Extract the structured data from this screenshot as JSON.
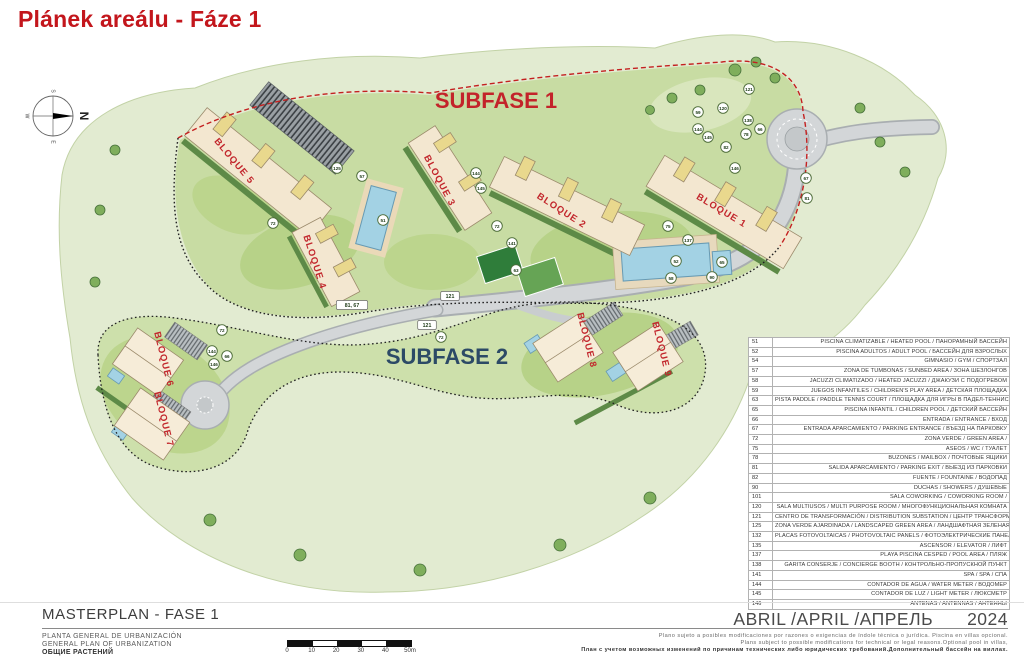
{
  "header": {
    "title": "Plánek areálu - Fáze 1"
  },
  "plan": {
    "subfase1_label": "SUBFASE 1",
    "subfase2_label": "SUBFASE 2",
    "compass": {
      "top": "S",
      "right": "N",
      "bottom": "E",
      "left": "W"
    },
    "bloques": [
      {
        "label": "BLOQUE 5",
        "x": 232,
        "y": 163,
        "rot": 50
      },
      {
        "label": "BLOQUE 3",
        "x": 437,
        "y": 182,
        "rot": 62
      },
      {
        "label": "BLOQUE 2",
        "x": 560,
        "y": 213,
        "rot": 33
      },
      {
        "label": "BLOQUE 1",
        "x": 720,
        "y": 213,
        "rot": 31
      },
      {
        "label": "BLOQUE 4",
        "x": 312,
        "y": 263,
        "rot": 72
      },
      {
        "label": "BLOQUE 6",
        "x": 161,
        "y": 360,
        "rot": 76
      },
      {
        "label": "BLOQUE 7",
        "x": 161,
        "y": 420,
        "rot": 76
      },
      {
        "label": "BLOQUE 8",
        "x": 584,
        "y": 341,
        "rot": 76
      },
      {
        "label": "BLOQUE 9",
        "x": 659,
        "y": 350,
        "rot": 76
      }
    ],
    "markers": [
      {
        "n": "125",
        "x": 337,
        "y": 168
      },
      {
        "n": "57",
        "x": 362,
        "y": 176
      },
      {
        "n": "51",
        "x": 383,
        "y": 220
      },
      {
        "n": "72",
        "x": 273,
        "y": 223
      },
      {
        "n": "72",
        "x": 497,
        "y": 226
      },
      {
        "n": "144",
        "x": 476,
        "y": 173
      },
      {
        "n": "145",
        "x": 481,
        "y": 188
      },
      {
        "n": "141",
        "x": 512,
        "y": 243
      },
      {
        "n": "63",
        "x": 516,
        "y": 270
      },
      {
        "n": "59",
        "x": 698,
        "y": 112
      },
      {
        "n": "120",
        "x": 723,
        "y": 108
      },
      {
        "n": "121",
        "x": 749,
        "y": 89
      },
      {
        "n": "138",
        "x": 748,
        "y": 120
      },
      {
        "n": "66",
        "x": 760,
        "y": 129
      },
      {
        "n": "144",
        "x": 698,
        "y": 129
      },
      {
        "n": "145",
        "x": 708,
        "y": 137
      },
      {
        "n": "78",
        "x": 746,
        "y": 134
      },
      {
        "n": "82",
        "x": 726,
        "y": 147
      },
      {
        "n": "146",
        "x": 735,
        "y": 168
      },
      {
        "n": "67",
        "x": 806,
        "y": 178
      },
      {
        "n": "81",
        "x": 807,
        "y": 198
      },
      {
        "n": "75",
        "x": 668,
        "y": 226
      },
      {
        "n": "137",
        "x": 688,
        "y": 240
      },
      {
        "n": "52",
        "x": 676,
        "y": 261
      },
      {
        "n": "65",
        "x": 722,
        "y": 262
      },
      {
        "n": "58",
        "x": 671,
        "y": 278
      },
      {
        "n": "90",
        "x": 712,
        "y": 277
      },
      {
        "n": "121",
        "x": 450,
        "y": 296,
        "box": true
      },
      {
        "n": "81, 67",
        "x": 352,
        "y": 305,
        "box": true
      },
      {
        "n": "121",
        "x": 427,
        "y": 325,
        "box": true
      },
      {
        "n": "66",
        "x": 227,
        "y": 356
      },
      {
        "n": "144",
        "x": 212,
        "y": 351
      },
      {
        "n": "146",
        "x": 214,
        "y": 364
      },
      {
        "n": "72",
        "x": 441,
        "y": 337
      },
      {
        "n": "72",
        "x": 222,
        "y": 330
      }
    ]
  },
  "legend": {
    "rows": [
      {
        "num": "51",
        "desc": "PISCINA CLIMATIZABLE / HEATED POOL / ПАНОРАМНЫЙ БАССЕЙН"
      },
      {
        "num": "52",
        "desc": "PISCINA ADULTOS / ADULT POOL / БАССЕЙН ДЛЯ ВЗРОСЛЫХ"
      },
      {
        "num": "54",
        "desc": "GIMNASIO / GYM / СПОРТЗАЛ"
      },
      {
        "num": "57",
        "desc": "ZONA DE TUMBONAS / SUNBED AREA / ЗОНА ШЕЗЛОНГОВ"
      },
      {
        "num": "58",
        "desc": "JACUZZI CLIMATIZADO / HEATED JACUZZI / ДЖАКУЗИ С ПОДОГРЕВОМ"
      },
      {
        "num": "59",
        "desc": "JUEGOS INFANTILES / CHILDREN'S PLAY AREA / ДЕТСКАЯ ПЛОЩАДКА"
      },
      {
        "num": "63",
        "desc": "PISTA PADDLE / PADDLE TENNIS COURT / ПЛОЩАДКА ДЛЯ ИГРЫ В ПАДЕЛ-ТЕННИС"
      },
      {
        "num": "65",
        "desc": "PISCINA INFANTIL / CHILDREN POOL / ДЕТСКИЙ БАССЕЙН"
      },
      {
        "num": "66",
        "desc": "ENTRADA / ENTRANCE / ВХОД"
      },
      {
        "num": "67",
        "desc": "ENTRADA APARCAMIENTO / PARKING ENTRANCE / ВЪЕЗД НА ПАРКОВКУ"
      },
      {
        "num": "72",
        "desc": "ZONA VERDE / GREEN AREA /"
      },
      {
        "num": "75",
        "desc": "ASEOS / WC / ТУАЛЕТ"
      },
      {
        "num": "78",
        "desc": "BUZONES / MAILBOX / ПОЧТОВЫЕ ЯЩИКИ"
      },
      {
        "num": "81",
        "desc": "SALIDA APARCAMIENTO / PARKING EXIT / ВЫЕЗД ИЗ ПАРКОВКИ"
      },
      {
        "num": "82",
        "desc": "FUENTE / FOUNTAINE / ВОДОПАД"
      },
      {
        "num": "90",
        "desc": "DUCHAS / SHOWERS / ДУШЕВЫЕ"
      },
      {
        "num": "101",
        "desc": "SALA COWORKING / COWORKING ROOM /"
      },
      {
        "num": "120",
        "desc": "SALA MULTIUSOS / MULTI PURPOSE ROOM / МНОГОФУНКЦИОНАЛЬНАЯ КОМНАТА"
      },
      {
        "num": "121",
        "desc": "CENTRO DE TRANSFORMACIÓN / DISTRIBUTION SUBSTATION / ЦЕНТР ТРАНСФОРМАЦИИ"
      },
      {
        "num": "125",
        "desc": "ZONA VERDE AJARDINADA / LANDSCAPED GREEN AREA / ЛАНДШАФТНАЯ ЗЕЛЕНАЯ ЗОНА"
      },
      {
        "num": "132",
        "desc": "PLACAS FOTOVOLTAICAS / PHOTOVOLTAIC PANELS / ФОТОЭЛЕКТРИЧЕСКИЕ ПАНЕЛИ"
      },
      {
        "num": "135",
        "desc": "ASCENSOR / ELEVATOR / ЛИФТ"
      },
      {
        "num": "137",
        "desc": "PLAYA PISCINA CESPED / POOL AREA / ПЛЯЖ"
      },
      {
        "num": "138",
        "desc": "GARITA CONSERJE / CONCIERGE BOOTH / КОНТРОЛЬНО-ПРОПУСКНОЙ ПУНКТ"
      },
      {
        "num": "141",
        "desc": "SPA / SPA / СПА"
      },
      {
        "num": "144",
        "desc": "CONTADOR DE AGUA / WATER METER / ВОДОМЕР"
      },
      {
        "num": "145",
        "desc": "CONTADOR DE LUZ / LIGHT METER / ЛЮКСМЕТР"
      },
      {
        "num": "146",
        "desc": "ANTENAS / ANTENNAS / АНТЕННЫ"
      }
    ]
  },
  "footer": {
    "project_title": "MASTERPLAN - FASE 1",
    "subtitle_es": "PLANTA GENERAL DE URBANIZACIÓN",
    "subtitle_en": "GENERAL PLAN OF URBANIZATION",
    "subtitle_ru": "ОБЩИЕ РАСТЕНИЙ",
    "date_label": "ABRIL /APRIL /АПРЕЛЬ",
    "date_year": "2024",
    "disclaimer_es": "Plano sujeto a posibles modificaciones por razones o exigencias de índole técnica o jurídica. Piscina en villas opcional.",
    "disclaimer_en": "Plans subject to possible modifications for technical or legal reasons.Optional pool in villas,",
    "disclaimer_ru": "План с учетом возможных изменений по причинам технических либо юридических требований.Дополнительный бассейн на виллах.",
    "scale_ticks": [
      "0",
      "10",
      "20",
      "30",
      "40",
      "50m"
    ],
    "colors": {
      "accent_red": "#c3161c",
      "subfase2_blue": "#2c4a66",
      "pool_blue": "#a3d2e4"
    }
  }
}
